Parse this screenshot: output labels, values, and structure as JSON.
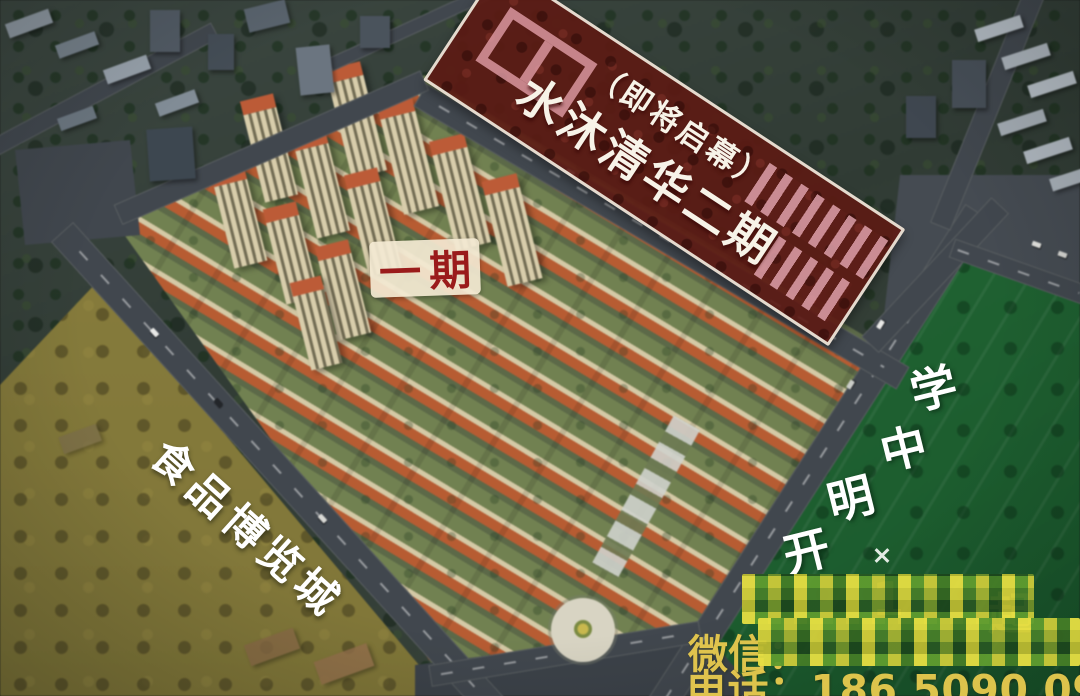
{
  "overlays": {
    "phase2_banner": {
      "subtitle": "（即将启幕）",
      "title": "水沐清华二期",
      "overlay_color": "#5c1a14",
      "text_color": "#f7f3e8"
    },
    "phase1_badge": {
      "label": "一期",
      "text_color": "#9a1b1b",
      "bg_color": "#f3e9d3"
    },
    "food_expo": {
      "label": "食品博览城",
      "overlay_color": "#8a7b35",
      "text_color": "#ffffff"
    },
    "school": {
      "label": "开明中学",
      "chars": [
        "开",
        "明",
        "中",
        "学"
      ],
      "overlay_color": "#1d6832",
      "text_color": "#ffffff"
    }
  },
  "contact": {
    "censored": true,
    "line1_fragments": [
      "1",
      "起"
    ],
    "wechat_prefix": "微信：",
    "phone_line": "电话：186 5090 0906",
    "text_color": "#e6c94e"
  }
}
